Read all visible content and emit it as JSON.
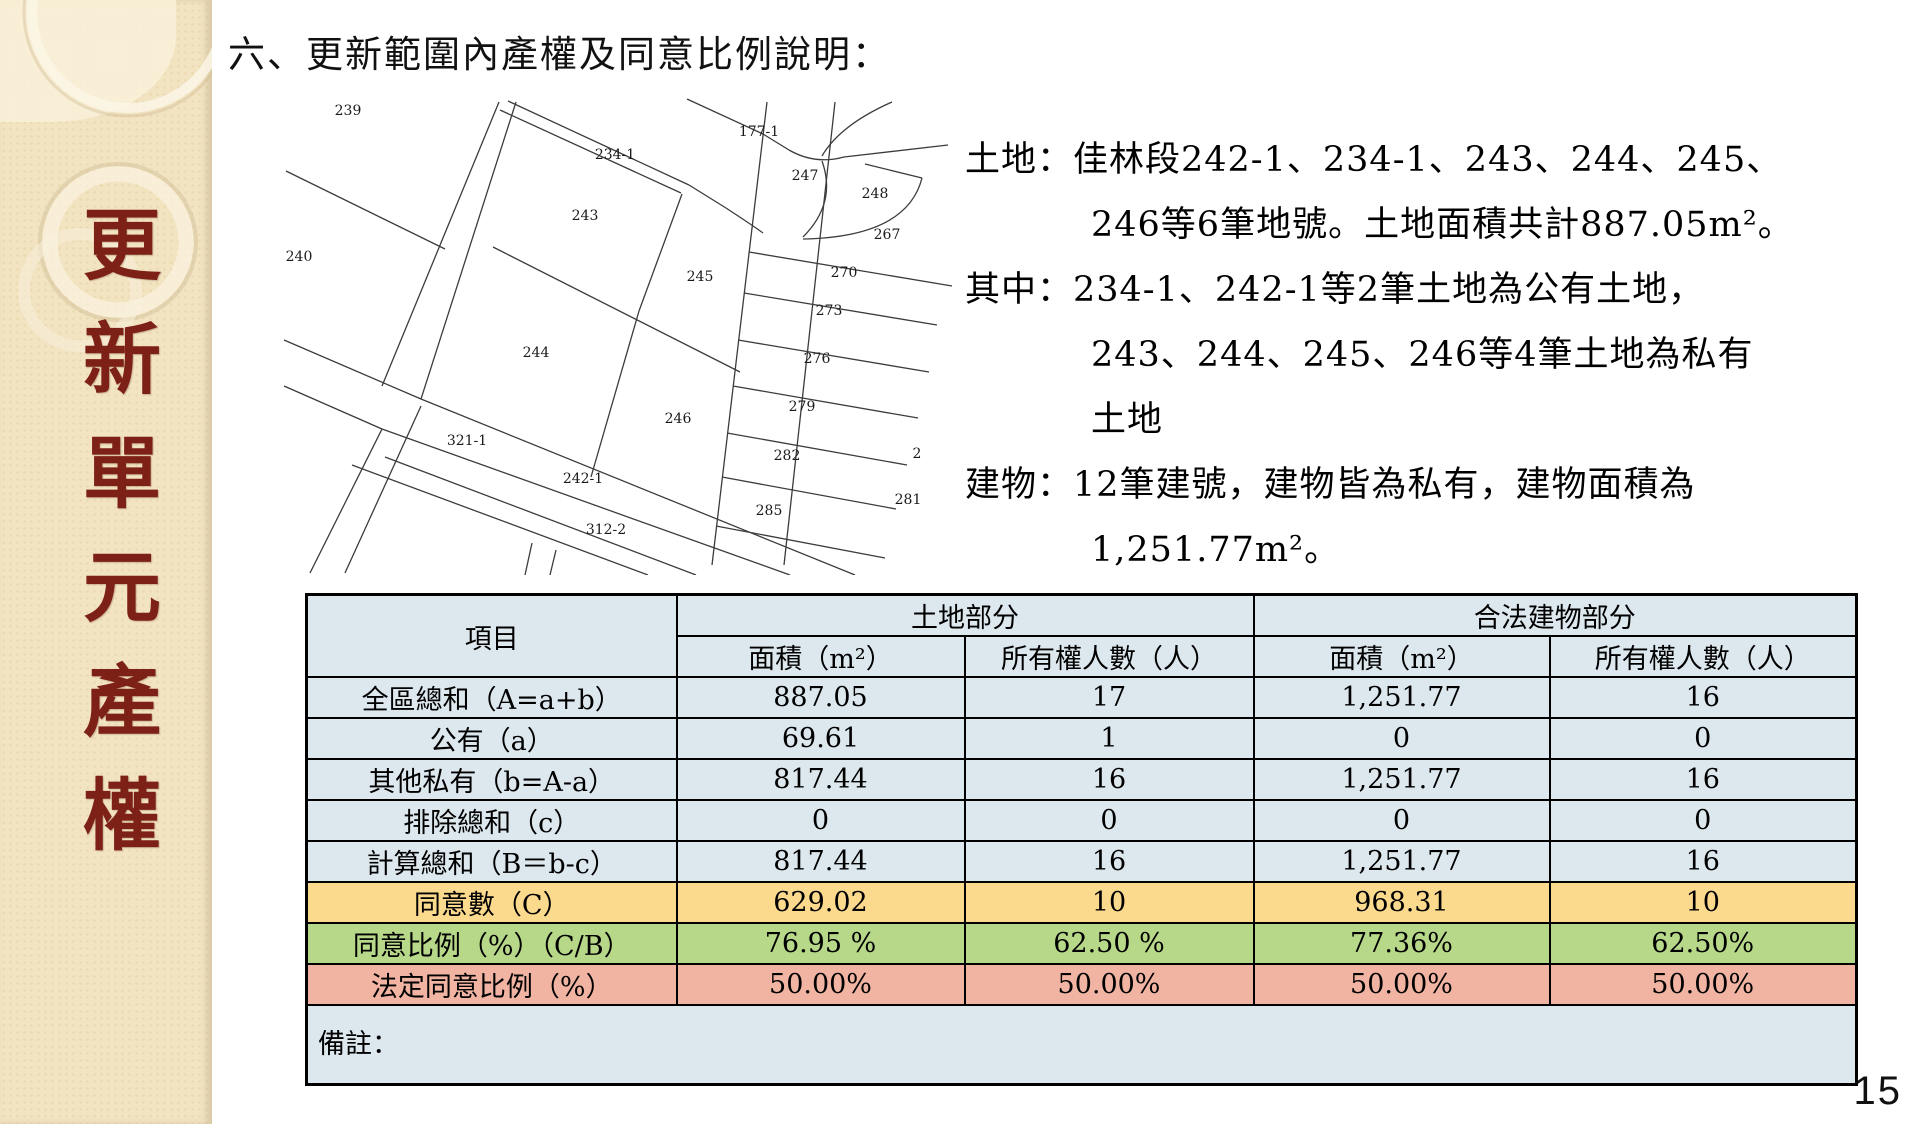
{
  "sidebar": {
    "vertical_title": "更新單元產權"
  },
  "title": "六、更新範圍內產權及同意比例說明：",
  "description": {
    "lines": [
      {
        "text": "土地：佳林段242-1、234-1、243、244、245、",
        "indent": false
      },
      {
        "text": "246等6筆地號。土地面積共計887.05m²。",
        "indent": true
      },
      {
        "text": "其中：234-1、242-1等2筆土地為公有土地，",
        "indent": false
      },
      {
        "text": "243、244、245、246等4筆土地為私有",
        "indent": true
      },
      {
        "text": "土地",
        "indent": true
      },
      {
        "text": "建物：12筆建號，建物皆為私有，建物面積為",
        "indent": false
      },
      {
        "text": "1,251.77m²。",
        "indent": true
      }
    ]
  },
  "map": {
    "parcels": [
      {
        "label": "239",
        "x": 118,
        "y": 30
      },
      {
        "label": "240",
        "x": 69,
        "y": 176
      },
      {
        "label": "234-1",
        "x": 385,
        "y": 74
      },
      {
        "label": "243",
        "x": 355,
        "y": 135
      },
      {
        "label": "177-1",
        "x": 529,
        "y": 51
      },
      {
        "label": "247",
        "x": 575,
        "y": 95
      },
      {
        "label": "248",
        "x": 645,
        "y": 113
      },
      {
        "label": "267",
        "x": 657,
        "y": 154
      },
      {
        "label": "270",
        "x": 614,
        "y": 192
      },
      {
        "label": "245",
        "x": 470,
        "y": 196
      },
      {
        "label": "273",
        "x": 599,
        "y": 230
      },
      {
        "label": "276",
        "x": 587,
        "y": 278
      },
      {
        "label": "244",
        "x": 306,
        "y": 272
      },
      {
        "label": "279",
        "x": 572,
        "y": 326
      },
      {
        "label": "246",
        "x": 448,
        "y": 338
      },
      {
        "label": "282",
        "x": 557,
        "y": 375
      },
      {
        "label": "2",
        "x": 687,
        "y": 373
      },
      {
        "label": "321-1",
        "x": 237,
        "y": 360
      },
      {
        "label": "242-1",
        "x": 353,
        "y": 398
      },
      {
        "label": "285",
        "x": 539,
        "y": 430
      },
      {
        "label": "281",
        "x": 678,
        "y": 419
      },
      {
        "label": "312-2",
        "x": 376,
        "y": 449
      }
    ]
  },
  "table": {
    "header": {
      "item": "項目",
      "land": "土地部分",
      "building": "合法建物部分",
      "area": "面積（m²）",
      "owners": "所有權人數（人）"
    },
    "rows": [
      {
        "label": "全區總和（A=a+b）",
        "values": [
          "887.05",
          "17",
          "1,251.77",
          "16"
        ],
        "color": "default"
      },
      {
        "label": "公有（a）",
        "values": [
          "69.61",
          "1",
          "0",
          "0"
        ],
        "color": "default"
      },
      {
        "label": "其他私有（b=A-a）",
        "values": [
          "817.44",
          "16",
          "1,251.77",
          "16"
        ],
        "color": "default"
      },
      {
        "label": "排除總和（c）",
        "values": [
          "0",
          "0",
          "0",
          "0"
        ],
        "color": "default"
      },
      {
        "label": "計算總和（B＝b-c）",
        "values": [
          "817.44",
          "16",
          "1,251.77",
          "16"
        ],
        "color": "default"
      },
      {
        "label": "同意數（C）",
        "values": [
          "629.02",
          "10",
          "968.31",
          "10"
        ],
        "color": "yellow"
      },
      {
        "label": "同意比例（%）（C/B）",
        "values": [
          "76.95 %",
          "62.50 %",
          "77.36%",
          "62.50%"
        ],
        "color": "green"
      },
      {
        "label": "法定同意比例（%）",
        "values": [
          "50.00%",
          "50.00%",
          "50.00%",
          "50.00%"
        ],
        "color": "red"
      }
    ],
    "note_label": "備註："
  },
  "page": {
    "number": "15"
  },
  "colors": {
    "sidebar_bg": "#f2e3c1",
    "title_text": "#7d2016",
    "table_base": "#dde8ee",
    "row_yellow": "#fbd98d",
    "row_green": "#b7d789",
    "row_red": "#f1b4a2"
  }
}
